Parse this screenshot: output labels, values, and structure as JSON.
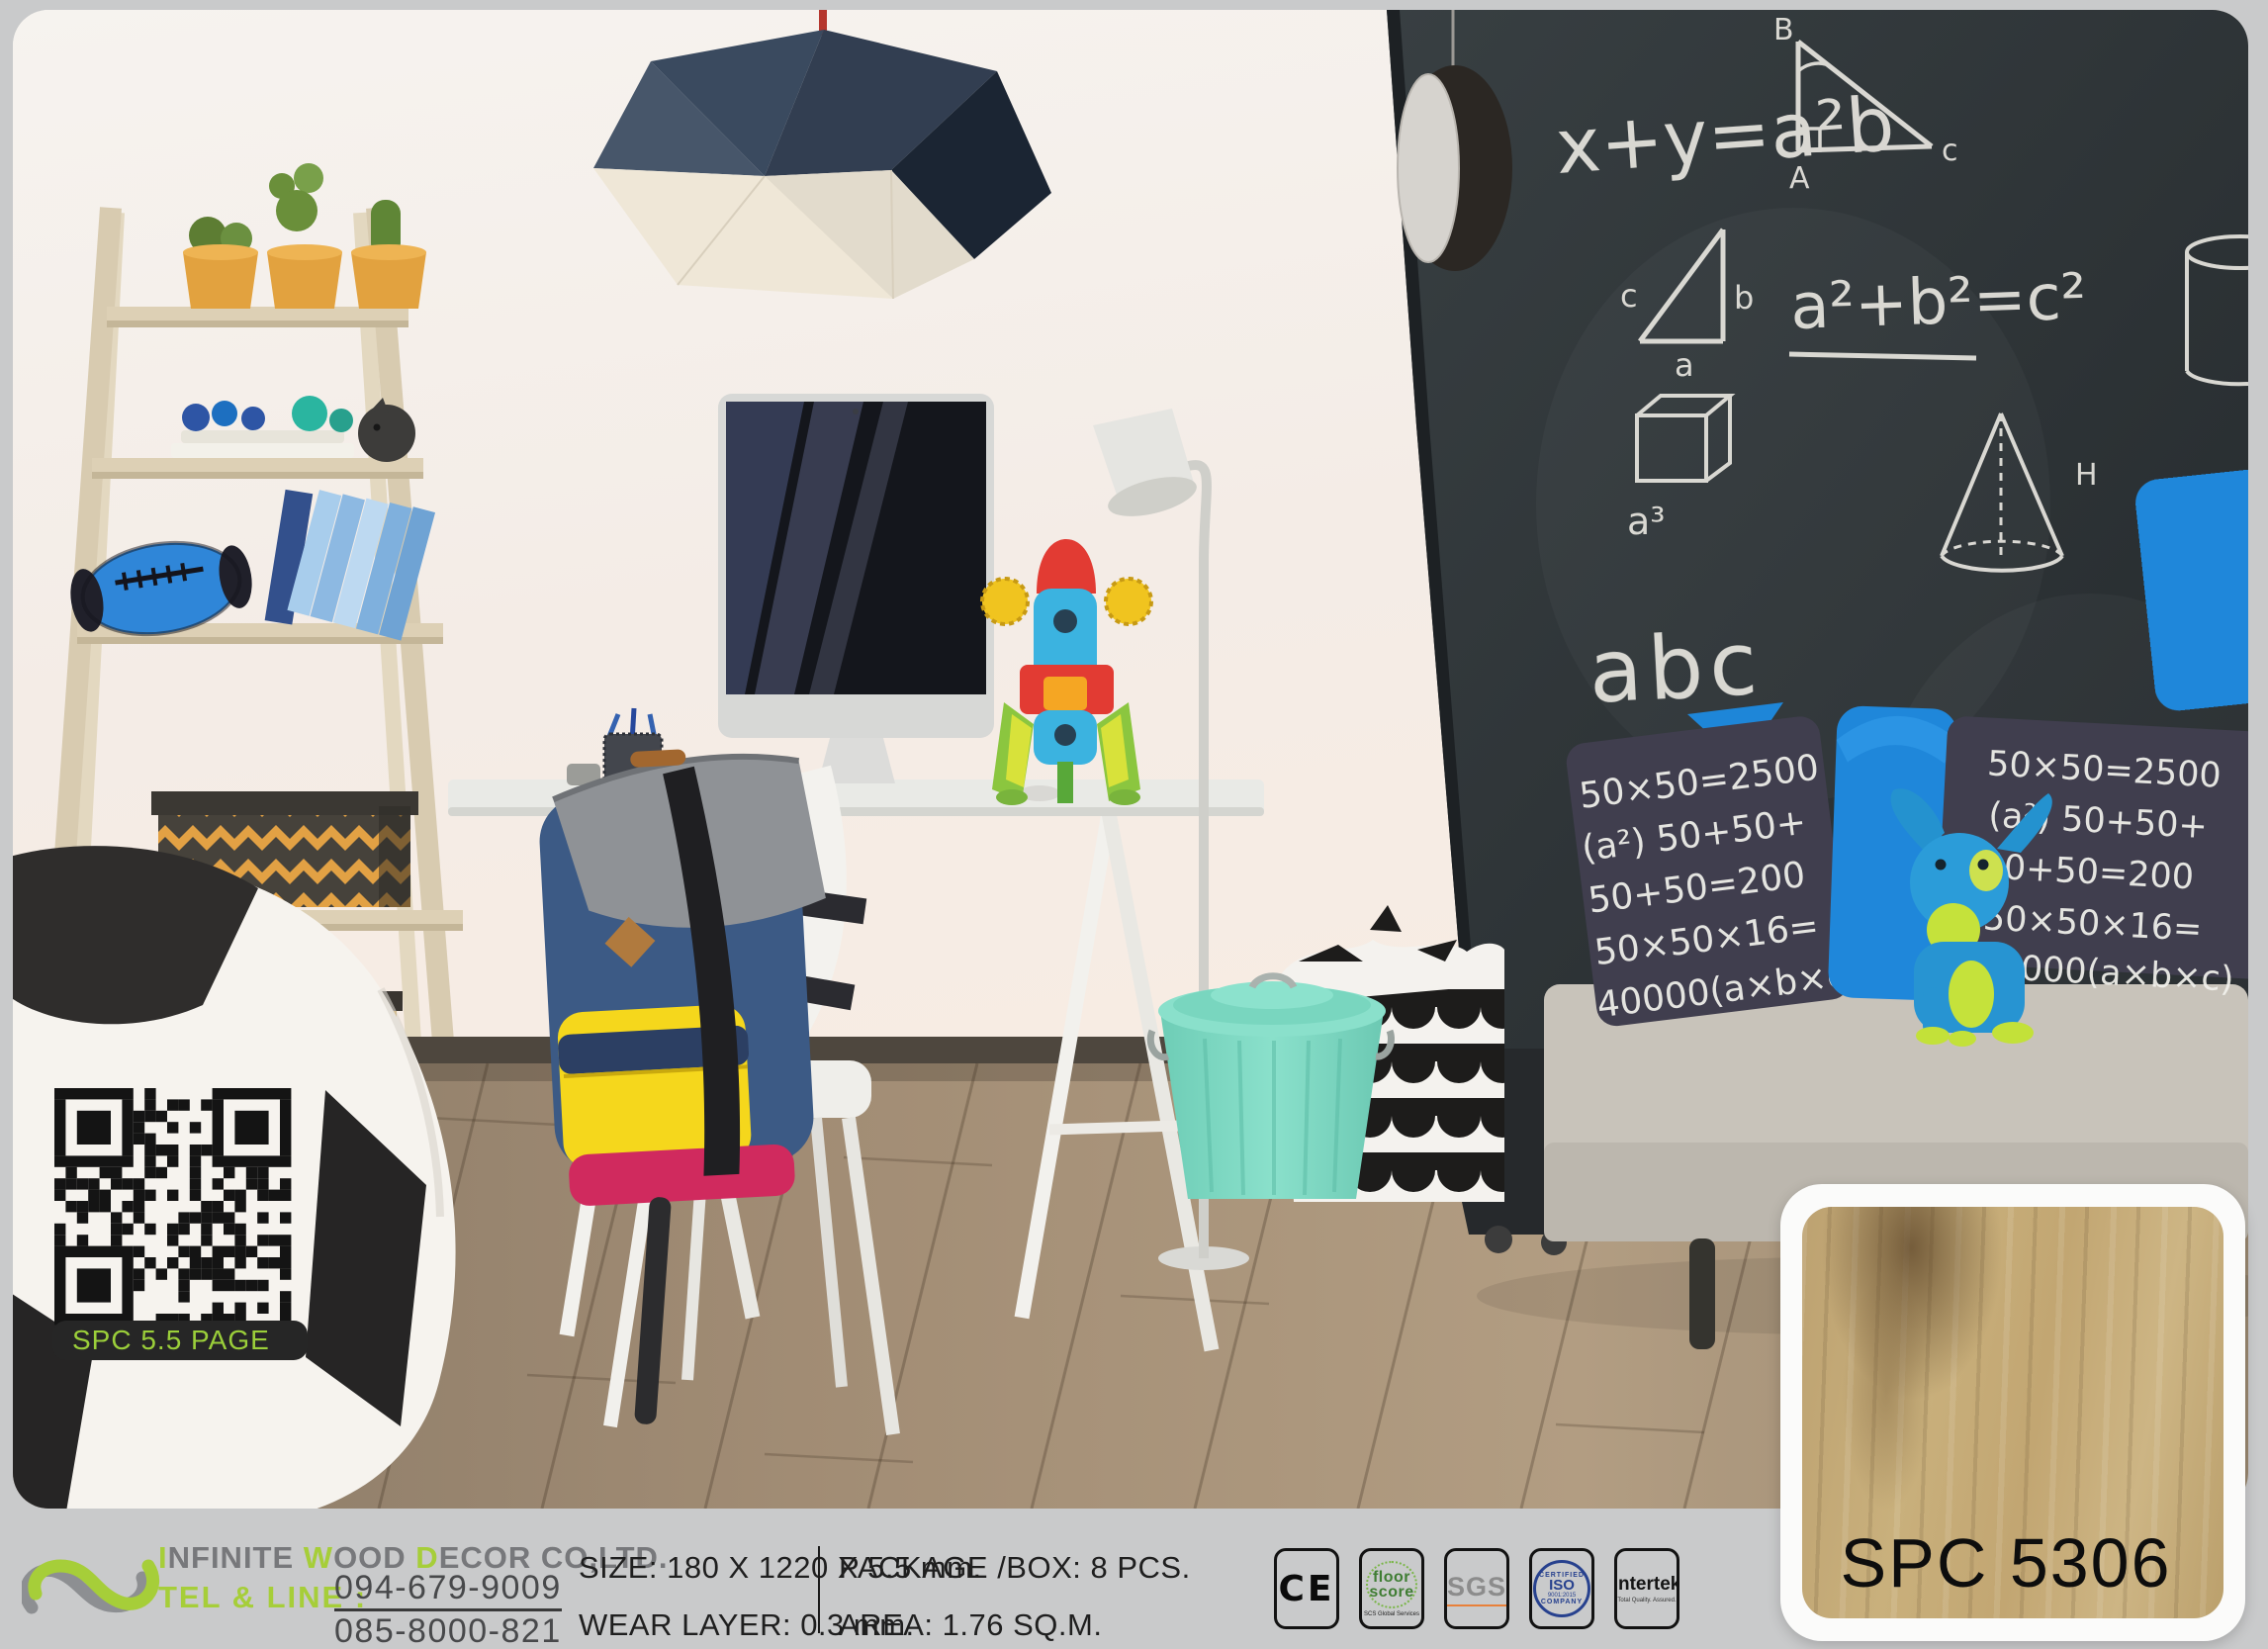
{
  "page": {
    "background": "#c9cacb"
  },
  "brand": {
    "accent_green": "#a6ce39",
    "logo_gray": "#8d8f92",
    "company_segments": {
      "s1": "I",
      "s2": "NFINITE ",
      "s3": "W",
      "s4": "OOD ",
      "s5": "D",
      "s6": "ECOR CO,LTD."
    },
    "tel_label": "TEL & LINE :",
    "phone1": "094-679-9009",
    "phone2": "085-8000-821"
  },
  "specs": {
    "size": "SIZE: 180 X 1220 X 5.5 mm.",
    "wear_layer": "WEAR LAYER: 0.3 mm.",
    "package_box": "PACKAGE /BOX:  8 PCS.",
    "area": "AREA:  1.76 SQ.M."
  },
  "badges": {
    "ce": {
      "label": "CE"
    },
    "floorscore": {
      "word1": "floor",
      "word2": "score",
      "sub": "SCS Global Services"
    },
    "sgs": {
      "label": "SGS"
    },
    "iso": {
      "arc_top": "CERTIFIED",
      "center": "ISO",
      "num": "9001:2015",
      "arc_bottom": "COMPANY"
    },
    "intertek": {
      "label": "intertek",
      "sub": "Total Quality. Assured."
    }
  },
  "product": {
    "code": "SPC 5306"
  },
  "qr": {
    "label": "SPC 5.5 PAGE",
    "label_color": "#9bcf3a"
  },
  "photo": {
    "chalkboard": {
      "eq1": "x+y=a²b",
      "eq2": "a²+b²=c²",
      "abc": "abc",
      "a3": "a³",
      "cone_label": "H",
      "tri1_top": "B",
      "tri1_corner": "A",
      "tri1_right": "c",
      "tri2_left": "c",
      "tri2_right": "b",
      "tri2_bottom": "a"
    },
    "pillow_lines": [
      "50×50=2500",
      "(a²) 50+50+",
      "50+50=200",
      "50×50×16=",
      "40000(a×b×c)"
    ]
  }
}
